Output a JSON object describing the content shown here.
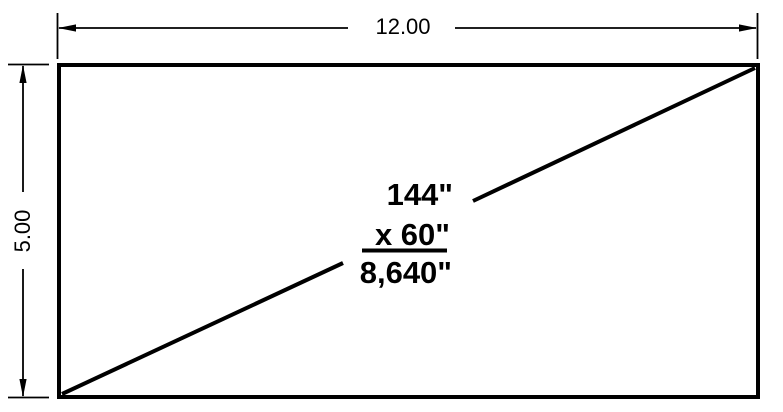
{
  "diagram": {
    "type": "dimensioned-rectangle-drawing",
    "dimensions": {
      "width_label": "12.00",
      "height_label": "5.00"
    },
    "area_calculation": {
      "line1": "144\"",
      "line2": "x 60\"",
      "result": "8,640\""
    }
  },
  "colors": {
    "line": "#000000",
    "background": "#ffffff"
  }
}
